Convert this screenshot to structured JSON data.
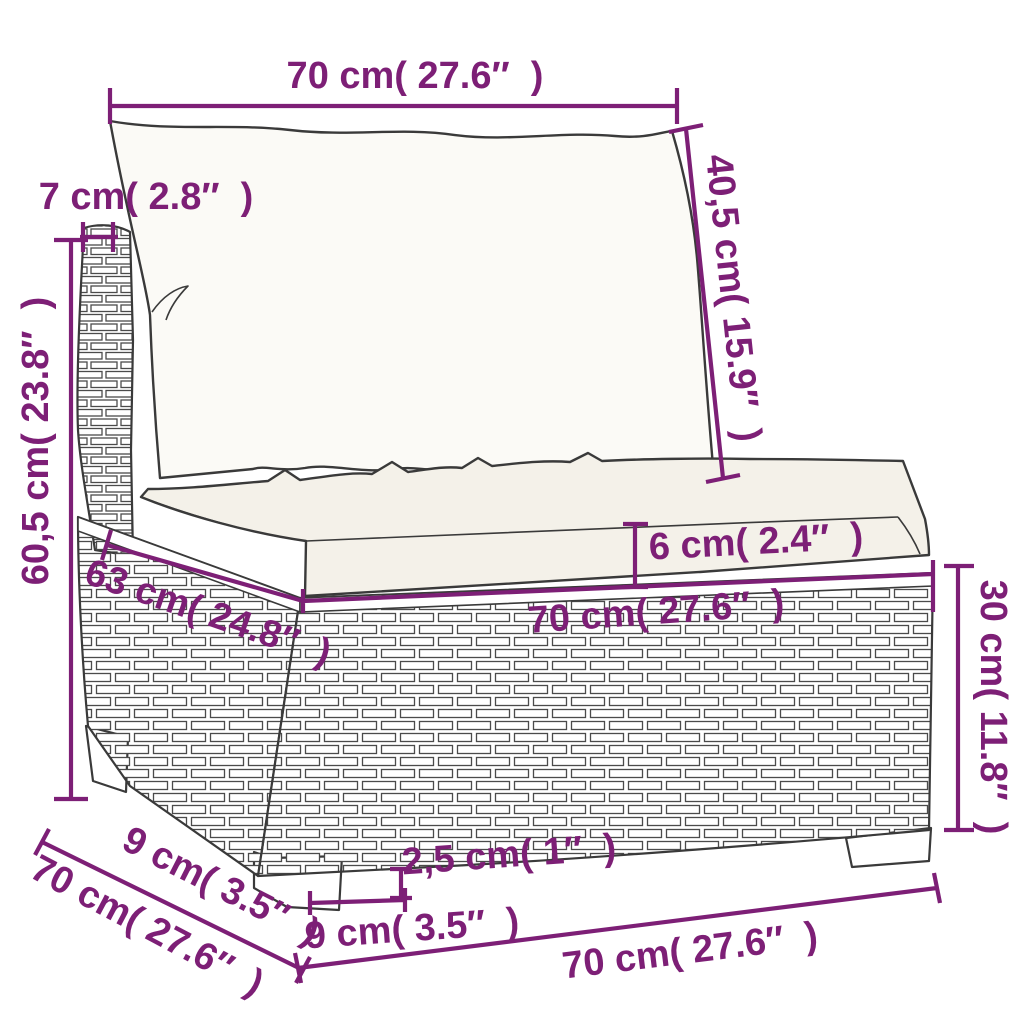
{
  "diagram": {
    "title": "sofa-section-dimension-diagram",
    "product": "poly rattan sectional sofa middle seat with back cushion and seat cushion",
    "accent_color": "#7d1f76",
    "line_color": "#3a3a3a",
    "background_color": "#ffffff",
    "dimensions": [
      {
        "id": "back-cushion-width",
        "label": "70 cm( 27.6″  )"
      },
      {
        "id": "back-cushion-height",
        "label": "40,5 cm( 15.9″  )"
      },
      {
        "id": "back-post-width",
        "label": "7 cm( 2.8″  )"
      },
      {
        "id": "total-height",
        "label": "60,5 cm( 23.8″  )"
      },
      {
        "id": "seat-depth",
        "label": "63 cm( 24.8″  )"
      },
      {
        "id": "seat-cushion-thickness",
        "label": "6 cm( 2.4″  )"
      },
      {
        "id": "seat-width",
        "label": "70 cm( 27.6″  )"
      },
      {
        "id": "base-height",
        "label": "30 cm( 11.8″  )"
      },
      {
        "id": "leg-height",
        "label": "2,5 cm( 1″  )"
      },
      {
        "id": "leg-width",
        "label": "9 cm( 3.5″  )"
      },
      {
        "id": "leg-depth",
        "label": "9 cm( 3.5″  )"
      },
      {
        "id": "base-depth",
        "label": "70 cm( 27.6″  )"
      },
      {
        "id": "base-width",
        "label": "70 cm( 27.6″  )"
      }
    ]
  }
}
